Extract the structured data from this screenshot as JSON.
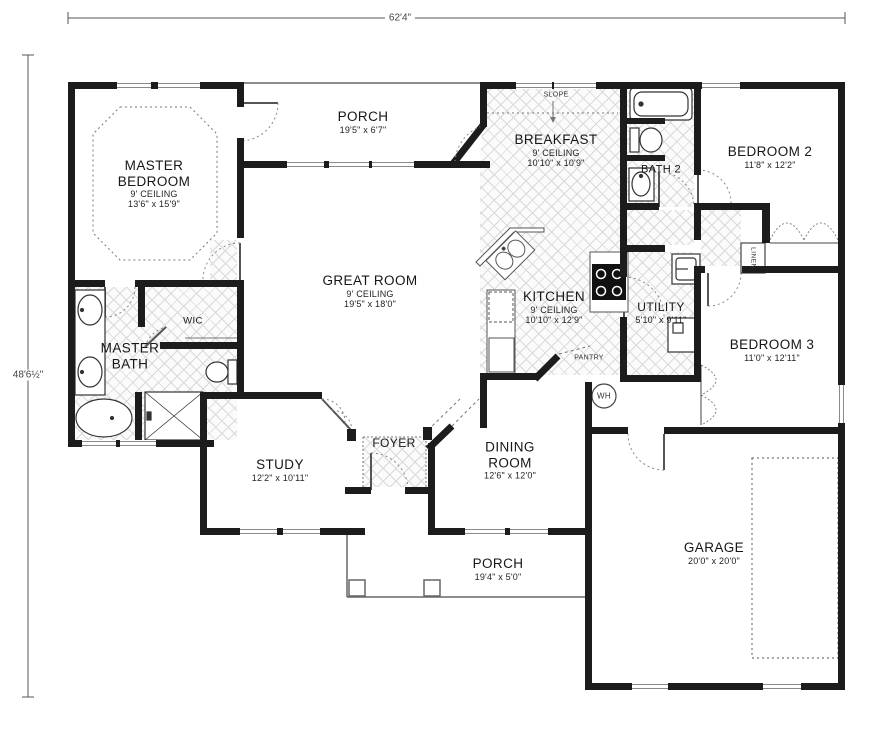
{
  "dimensions": {
    "overall_width": "62'4\"",
    "overall_height": "48'6½\""
  },
  "rooms": [
    {
      "name": "MASTER BEDROOM",
      "ceiling": "9' CEILING",
      "dims": "13'6\" x 15'9\""
    },
    {
      "name": "PORCH",
      "dims": "19'5\" x 6'7\""
    },
    {
      "name": "BREAKFAST",
      "ceiling": "9' CEILING",
      "dims": "10'10\" x 10'9\""
    },
    {
      "name": "BATH 2"
    },
    {
      "name": "BEDROOM 2",
      "dims": "11'8\" x 12'2\""
    },
    {
      "name": "GREAT ROOM",
      "ceiling": "9' CEILING",
      "dims": "19'5\" x 18'0\""
    },
    {
      "name": "KITCHEN",
      "ceiling": "9' CEILING",
      "dims": "10'10\" x 12'9\""
    },
    {
      "name": "UTILITY",
      "dims": "5'10\" x 9'11\""
    },
    {
      "name": "BEDROOM 3",
      "dims": "11'0\" x 12'11\""
    },
    {
      "name": "MASTER BATH"
    },
    {
      "name": "WIC"
    },
    {
      "name": "STUDY",
      "dims": "12'2\" x 10'11\""
    },
    {
      "name": "FOYER"
    },
    {
      "name": "DINING ROOM",
      "dims": "12'6\" x 12'0\""
    },
    {
      "name": "PORCH",
      "dims": "19'4\" x 5'0\""
    },
    {
      "name": "GARAGE",
      "dims": "20'0\" x 20'0\""
    }
  ],
  "annotations": {
    "slope": "SLOPE",
    "pantry": "PANTRY",
    "wh": "WH",
    "linen": "LINEN"
  },
  "colors": {
    "wall": "#1c1c1c",
    "hatch_line": "#d9d9d9",
    "dash": "#666666"
  }
}
